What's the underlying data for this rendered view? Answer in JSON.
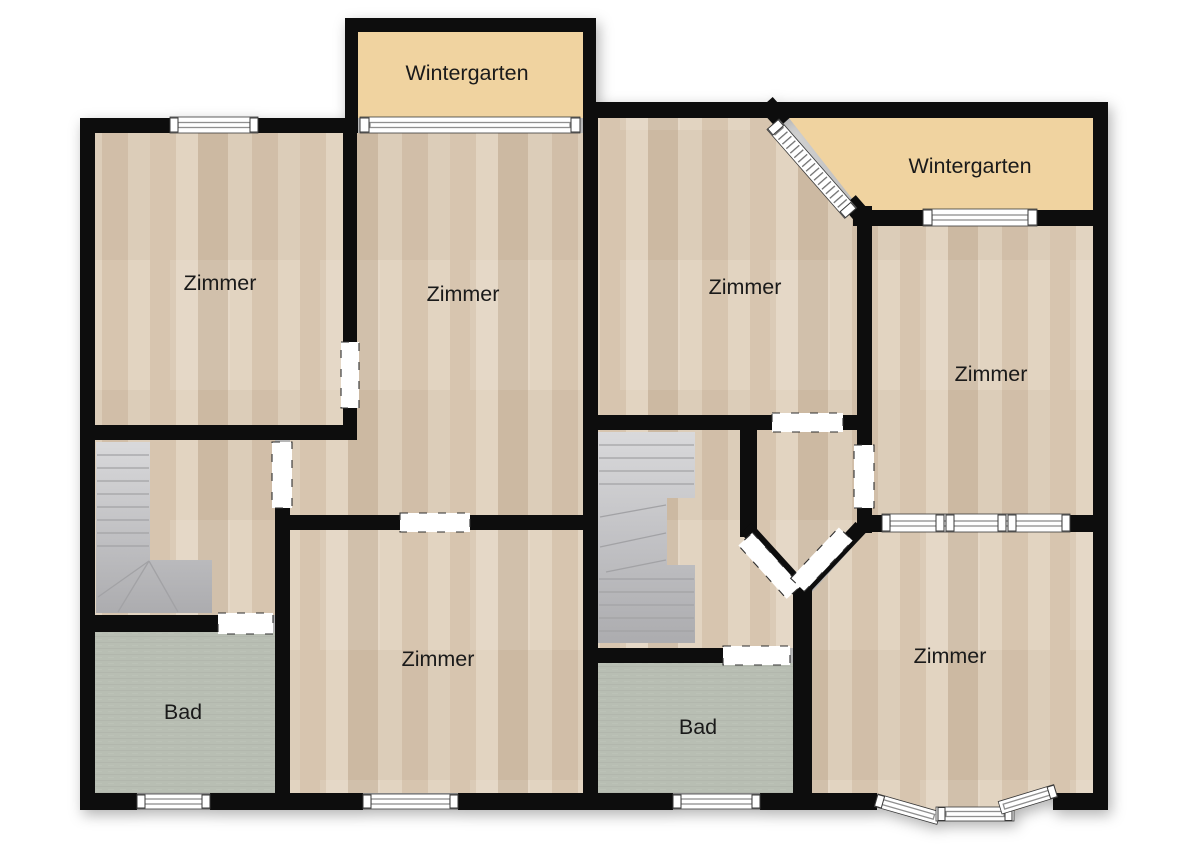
{
  "type": "floor_plan",
  "rooms": {
    "zimmer_top_left": {
      "label": "Zimmer"
    },
    "zimmer_center": {
      "label": "Zimmer"
    },
    "zimmer_top_middle": {
      "label": "Zimmer"
    },
    "zimmer_right": {
      "label": "Zimmer"
    },
    "zimmer_bottom_middle": {
      "label": "Zimmer"
    },
    "zimmer_bottom_right": {
      "label": "Zimmer"
    },
    "bad_left": {
      "label": "Bad"
    },
    "bad_middle": {
      "label": "Bad"
    },
    "wintergarten_top": {
      "label": "Wintergarten"
    },
    "wintergarten_right": {
      "label": "Wintergarten"
    }
  },
  "colors": {
    "wall": "#0d0d0d",
    "wood": "#d7c5af",
    "wood_light": "#e2d4c1",
    "wood_dark": "#ccb9a2",
    "wintergarten": "#f0d3a0",
    "bathroom": "#b8beb3",
    "stairs_light": "#d9d9db",
    "stairs_dark": "#acacaf",
    "window_frame": "#8f8f8f",
    "label": "#1a1a1a",
    "background": "#ffffff"
  }
}
